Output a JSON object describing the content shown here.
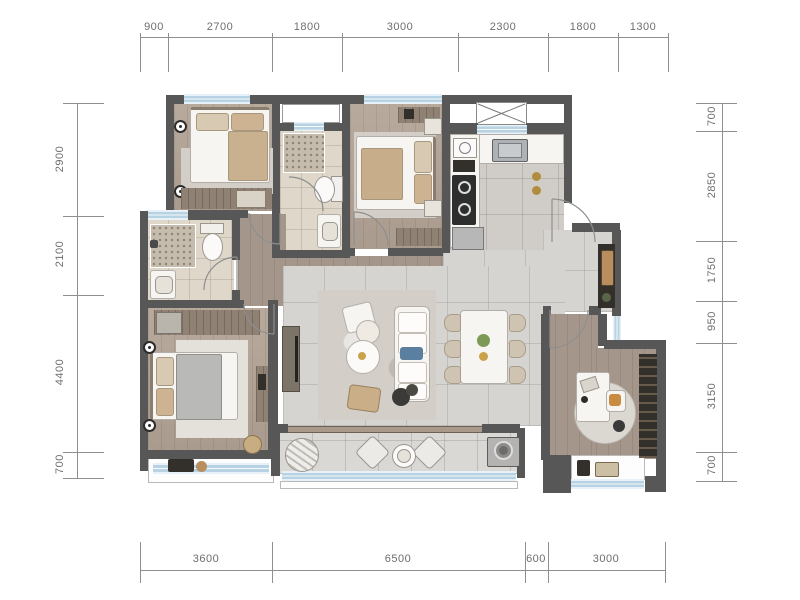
{
  "dimensions": {
    "top": [
      "900",
      "2700",
      "1800",
      "3000",
      "2300",
      "1800",
      "1300"
    ],
    "left": [
      "2900",
      "2100",
      "4400",
      "700"
    ],
    "right": [
      "700",
      "2850",
      "1750",
      "950",
      "3150",
      "700"
    ],
    "bottom": [
      "3600",
      "6500",
      "600",
      "3000"
    ]
  },
  "colors": {
    "wall": "#575757",
    "window_glass": "#b7d2e2",
    "wood_floor": "#b2a395",
    "tile_floor": "#d6d4d1",
    "bath_floor": "#ded7ca",
    "dimension_text": "#6e6e6e",
    "gold_accent": "#c0973f",
    "blue_pillow": "#5b7f9e",
    "plant_green": "#7c9a55",
    "seat_orange": "#c98b3f"
  },
  "furniture_icons": [
    "double-bed",
    "wardrobe",
    "wall-lamp",
    "toilet",
    "shower",
    "vanity-sink",
    "kitchen-sink",
    "stove",
    "fridge",
    "duct-shaft",
    "shoe-cabinet",
    "sofa",
    "armchair",
    "coffee-table",
    "tv-console",
    "dining-table",
    "dining-chair",
    "plant",
    "desk",
    "desk-chair",
    "bookshelf",
    "round-rug",
    "lounge-chair",
    "washing-machine",
    "dressing-table",
    "stool",
    "door-swing",
    "bay-window"
  ]
}
